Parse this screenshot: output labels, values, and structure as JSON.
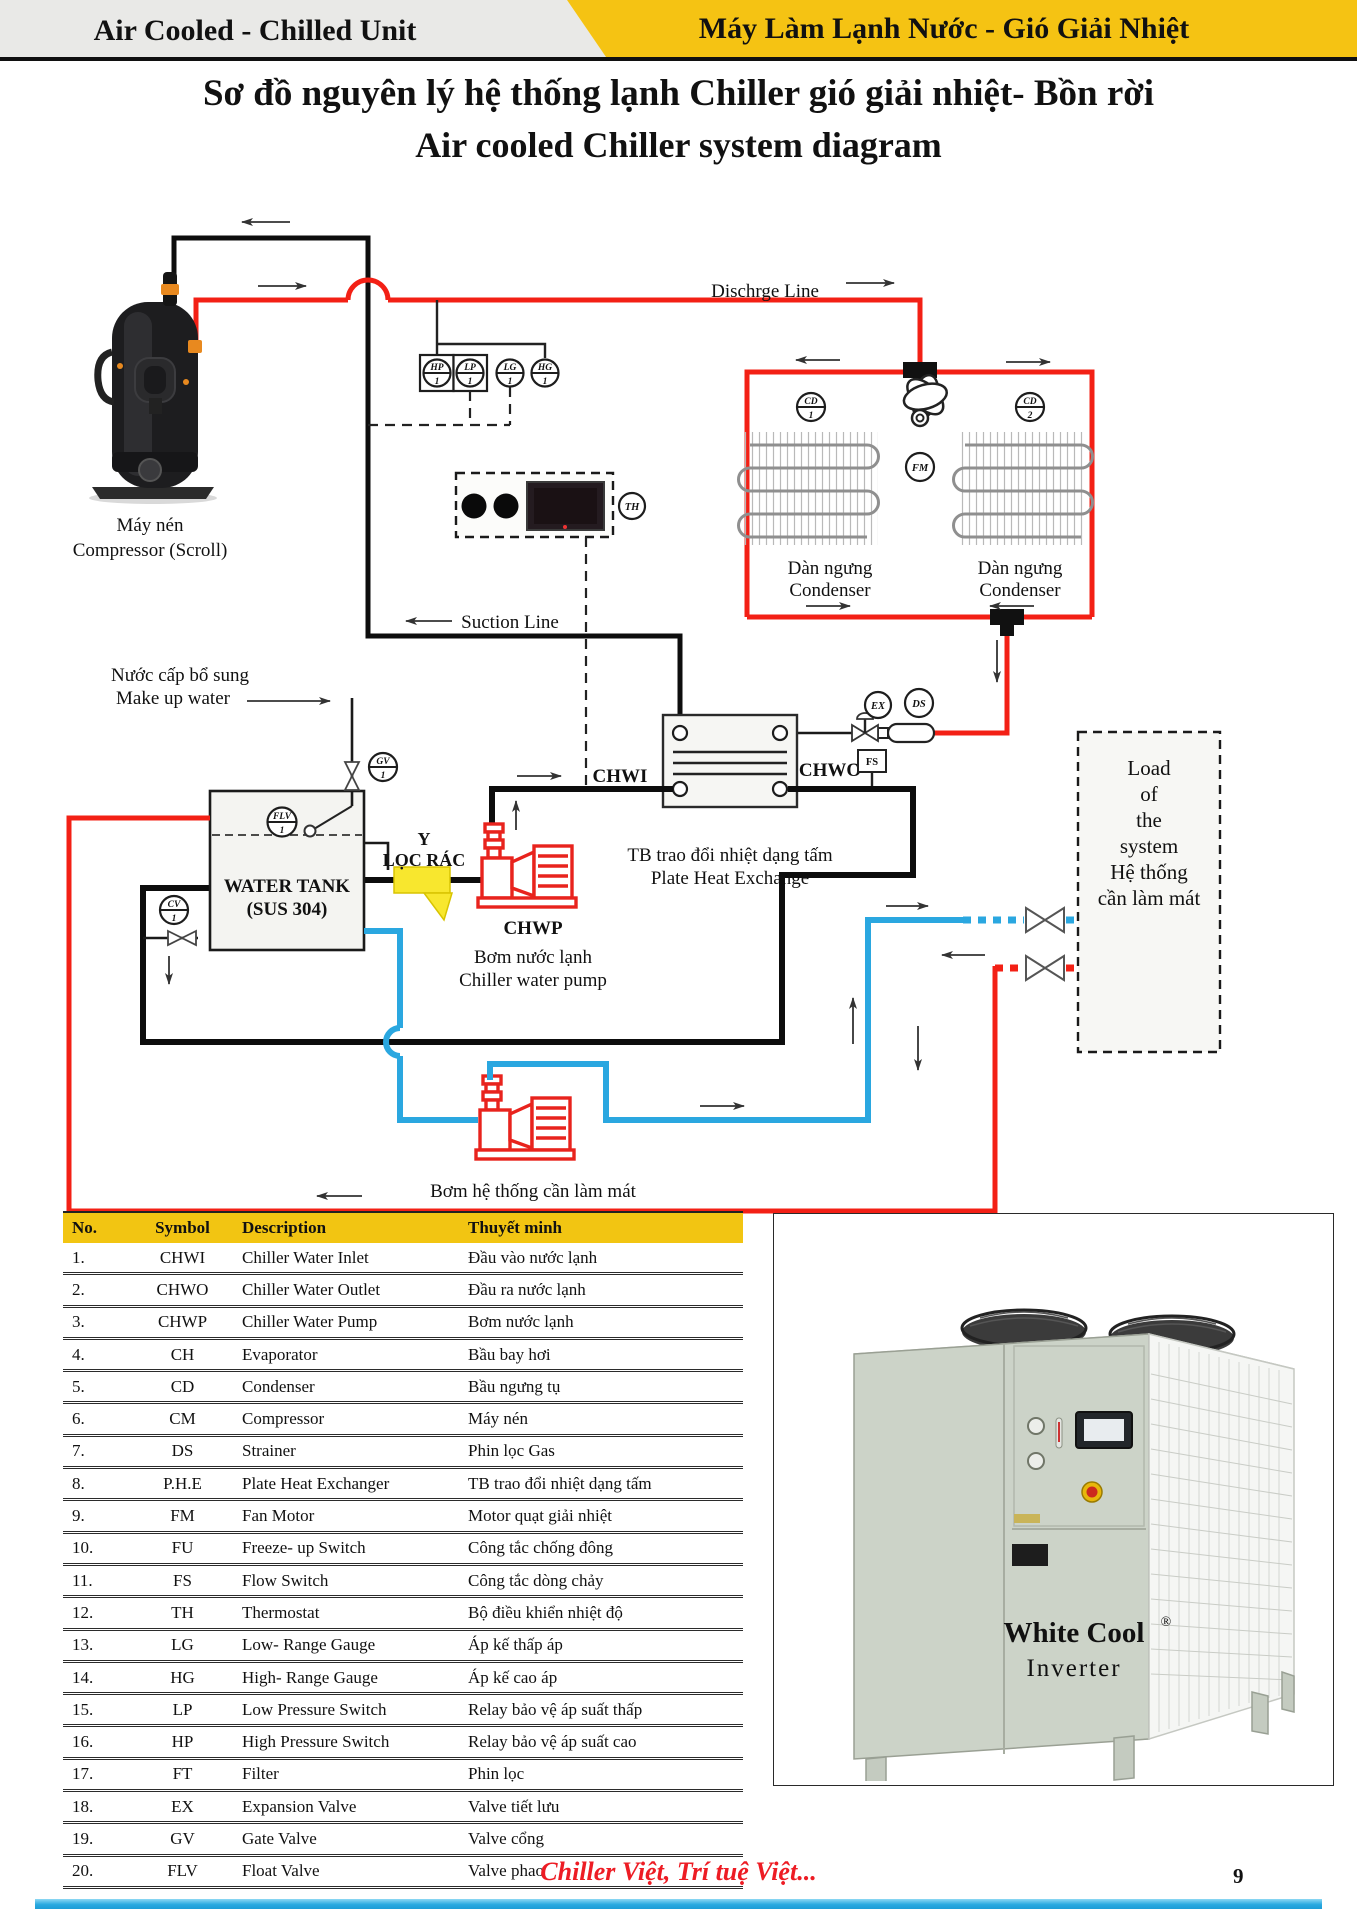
{
  "header": {
    "left": "Air Cooled - Chilled Unit",
    "right": "Máy Làm Lạnh Nước - Gió Giải Nhiệt"
  },
  "title": {
    "line1": "Sơ đồ nguyên lý hệ thống lạnh Chiller gió giải nhiệt- Bồn rời",
    "line2": "Air cooled Chiller system diagram"
  },
  "diagram": {
    "labels": {
      "may_nen": "Máy nén",
      "compressor": "Compressor (Scroll)",
      "discharge_line": "Dischrge Line",
      "suction_line": "Suction Line",
      "dan_ngung": "Dàn ngưng",
      "condenser": "Condenser",
      "nuoc_cap": "Nước cấp bổ sung",
      "makeup": "Make up water",
      "water_tank": "WATER TANK",
      "sus": "(SUS 304)",
      "y": "Y",
      "loc_rac": "LỌC RÁC",
      "chwp": "CHWP",
      "bom_nuoc_lanh": "Bơm nước lạnh",
      "chiller_water_pump": "Chiller water pump",
      "chwi": "CHWI",
      "chwo": "CHWO",
      "phe_vn": "TB trao đổi nhiệt dạng tấm",
      "phe_en": "Plate Heat Exchange",
      "bom_he_thong": "Bơm hệ thống cần làm mát",
      "load": [
        "Load",
        "of",
        "the",
        "system",
        "Hệ thống",
        "cần làm mát"
      ]
    },
    "inst": {
      "hp": "HP",
      "lp": "LP",
      "lg": "LG",
      "hg": "HG",
      "cd": "CD",
      "n1": "1",
      "n2": "2",
      "fm": "FM",
      "th": "TH",
      "ex": "EX",
      "ds": "DS",
      "fs": "FS",
      "gv": "GV",
      "cv": "CV",
      "flv": "FLV"
    },
    "colors": {
      "discharge_red": "#f32015",
      "chilled_blue": "#2aa7e0",
      "strainer_yellow": "#f8e72e",
      "pump_red": "#e8231d"
    }
  },
  "table": {
    "columns": [
      "No.",
      "Symbol",
      "Description",
      "Thuyết minh"
    ],
    "rows": [
      {
        "no": "1.",
        "symbol": "CHWI",
        "description": "Chiller Water Inlet",
        "vn": "Đầu vào nước lạnh"
      },
      {
        "no": "2.",
        "symbol": "CHWO",
        "description": "Chiller Water Outlet",
        "vn": "Đầu ra nước lạnh"
      },
      {
        "no": "3.",
        "symbol": "CHWP",
        "description": "Chiller Water Pump",
        "vn": "Bơm nước lạnh"
      },
      {
        "no": "4.",
        "symbol": "CH",
        "description": "Evaporator",
        "vn": "Bầu bay hơi"
      },
      {
        "no": "5.",
        "symbol": "CD",
        "description": "Condenser",
        "vn": "Bầu ngưng tụ"
      },
      {
        "no": "6.",
        "symbol": "CM",
        "description": "Compressor",
        "vn": "Máy nén"
      },
      {
        "no": "7.",
        "symbol": "DS",
        "description": "Strainer",
        "vn": "Phin lọc Gas"
      },
      {
        "no": "8.",
        "symbol": "P.H.E",
        "description": "Plate Heat Exchanger",
        "vn": "TB trao đổi nhiệt dạng tấm"
      },
      {
        "no": "9.",
        "symbol": "FM",
        "description": "Fan Motor",
        "vn": "Motor quạt giải nhiệt"
      },
      {
        "no": "10.",
        "symbol": "FU",
        "description": "Freeze- up Switch",
        "vn": "Công tắc chống đông"
      },
      {
        "no": "11.",
        "symbol": "FS",
        "description": "Flow Switch",
        "vn": "Công tắc dòng chảy"
      },
      {
        "no": "12.",
        "symbol": "TH",
        "description": "Thermostat",
        "vn": "Bộ điều khiển nhiệt độ"
      },
      {
        "no": "13.",
        "symbol": "LG",
        "description": "Low- Range Gauge",
        "vn": "Áp kế thấp áp"
      },
      {
        "no": "14.",
        "symbol": "HG",
        "description": "High- Range Gauge",
        "vn": "Áp kế cao áp"
      },
      {
        "no": "15.",
        "symbol": "LP",
        "description": "Low Pressure Switch",
        "vn": "Relay bảo vệ áp suất thấp"
      },
      {
        "no": "16.",
        "symbol": "HP",
        "description": "High Pressure Switch",
        "vn": "Relay bảo vệ áp suất cao"
      },
      {
        "no": "17.",
        "symbol": "FT",
        "description": "Filter",
        "vn": "Phin lọc"
      },
      {
        "no": "18.",
        "symbol": "EX",
        "description": "Expansion Valve",
        "vn": "Valve tiết lưu"
      },
      {
        "no": "19.",
        "symbol": "GV",
        "description": "Gate Valve",
        "vn": "Valve cổng"
      },
      {
        "no": "20.",
        "symbol": "FLV",
        "description": "Float Valve",
        "vn": "Valve phao"
      }
    ]
  },
  "product": {
    "brand": "White Cool",
    "reg": "®",
    "model": "Inverter"
  },
  "footer": {
    "slogan": "Chiller Việt, Trí tuệ Việt...",
    "page": "9"
  }
}
